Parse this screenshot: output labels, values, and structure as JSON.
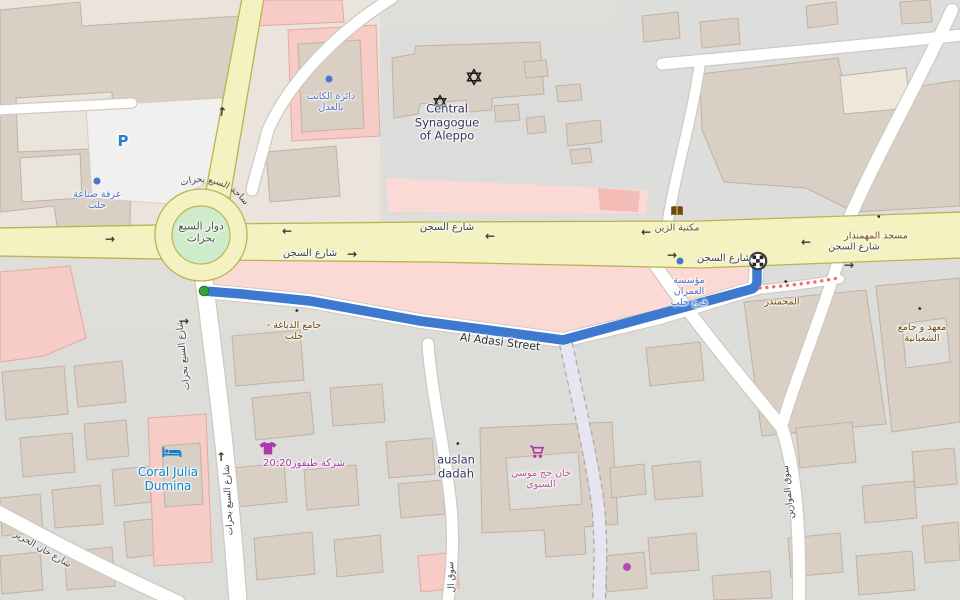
{
  "labels": {
    "roundabout": "دوار السبع بحرات",
    "roundabout_ring": "ساحة السبع بحرات",
    "sijn": "شارع السجن",
    "sabaa": "شارع السبع بحرات",
    "adasi": "Al Adasi Street",
    "khan_street": "شارع خان الحرير",
    "mawazin": "سوق الموازين",
    "souq_partial": "سوق ال",
    "synagogue": "Central Synagogue of Aleppo",
    "chamber": "غرفة صناعة حلب",
    "notary": "دائرة الكاتب بالعدل",
    "zain": "مكتبة الزين",
    "muhmandar_mosque": "مسجد المهمندار",
    "dabbagha": "جامع الدباغة - حلب",
    "omran": "مؤسسة العمران فرع حلب",
    "mahmandar": "المحمندر",
    "shaabaniya": "معهد و جامع الشعبانية",
    "coral": "Coral Julia Dumina",
    "tayfour": "شركة طيفور20:20",
    "auslan": "auslan dadah",
    "khan_haj": "خان حج موسي السيوي",
    "parking": "P"
  },
  "glyphs": {
    "arrow_left": "←",
    "arrow_right": "→",
    "arrow_up": "↑"
  },
  "colors": {
    "route_blue": "#3c79cf",
    "road_yellow": "#f4f2c0",
    "roundabout_green": "#ceeccc",
    "retail_pink": "#fbdad5",
    "building_taupe": "#d9cfc4",
    "start_marker_green": "#35a335",
    "poi_brown": "#734a08",
    "poi_office_blue": "#4d72c4",
    "poi_hotel_blue": "#0c82cf",
    "poi_shop_magenta": "#a939a9",
    "closure_red_dots": "#f07070"
  }
}
